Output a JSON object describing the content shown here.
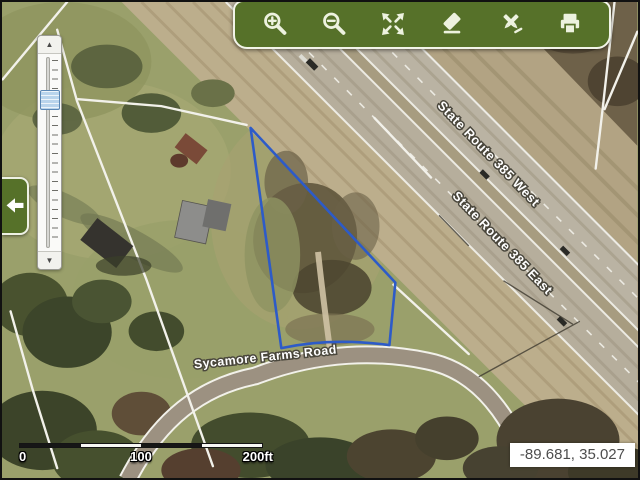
{
  "window": {
    "kind": "gis-parcel-map-viewer",
    "width": 640,
    "height": 480
  },
  "toolbar": {
    "background_color": "#567129",
    "icon_color": "#edf2df",
    "tools": [
      {
        "name": "zoom-in",
        "icon": "magnifier-plus-icon"
      },
      {
        "name": "zoom-out",
        "icon": "magnifier-minus-icon"
      },
      {
        "name": "full-extent",
        "icon": "expand-arrows-icon"
      },
      {
        "name": "clear-graphics",
        "icon": "eraser-icon"
      },
      {
        "name": "draw-measure",
        "icon": "drawing-tools-icon"
      },
      {
        "name": "print",
        "icon": "printer-icon"
      }
    ]
  },
  "side_panel_toggle": {
    "icon": "arrow-left-icon",
    "state": "open"
  },
  "zoom_slider": {
    "orientation": "vertical",
    "handle_color": "#b9d4ec",
    "buttons": [
      {
        "icon": "arrow-up-icon"
      },
      {
        "icon": "arrow-down-icon"
      }
    ]
  },
  "map": {
    "type": "aerial-imagery",
    "road_labels": [
      {
        "id": "sr385-west",
        "text": "State Route 385 West"
      },
      {
        "id": "sr385-east",
        "text": "State Route 385 East"
      },
      {
        "id": "sycamore",
        "text": "Sycamore Farms Road"
      }
    ],
    "selected_parcel_outline_color": "#2d5bc8",
    "parcel_line_color": "#f2f1ea"
  },
  "scale_bar": {
    "segments": 4,
    "labels": [
      "0",
      "100",
      "200ft"
    ]
  },
  "status": {
    "coordinates": "-89.681, 35.027"
  }
}
